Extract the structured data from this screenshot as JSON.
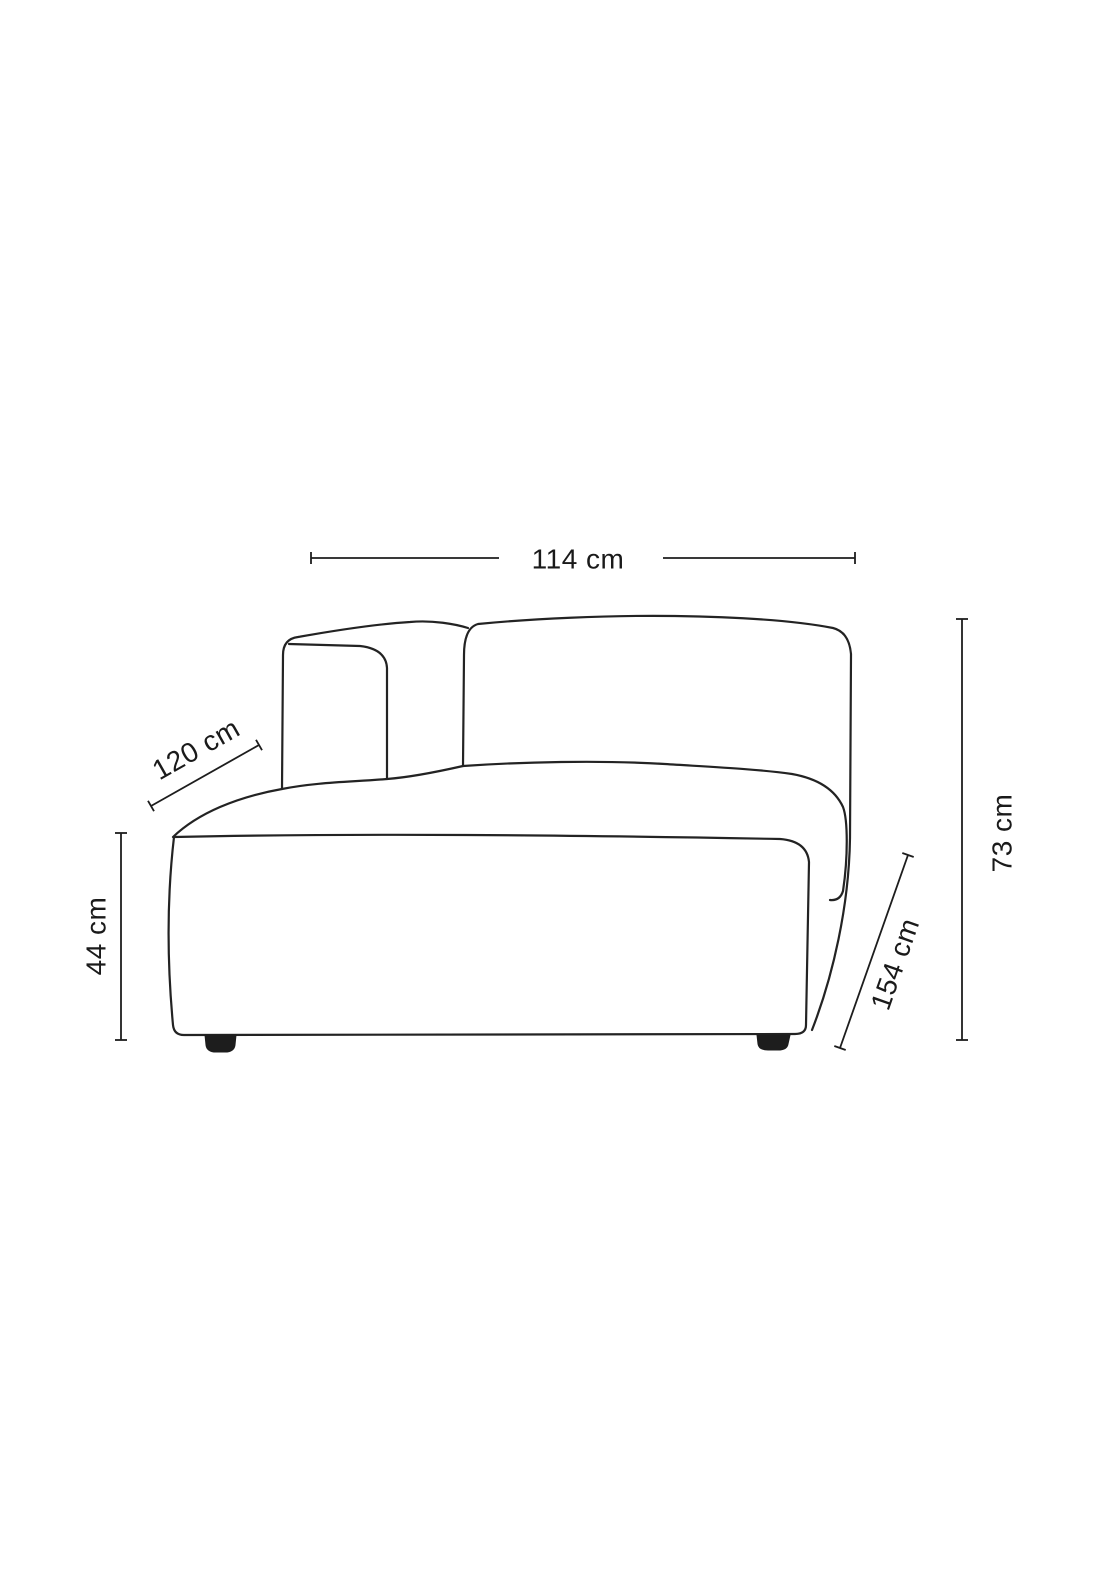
{
  "diagram": {
    "subject": "modular-sofa-chaise-outline",
    "background_color": "#ffffff",
    "line_color": "#232323",
    "feet_color": "#1d1d1d",
    "dimensions": {
      "width_top": {
        "label": "114 cm",
        "orientation": "horizontal"
      },
      "back_edge": {
        "label": "120 cm",
        "orientation": "diagonal"
      },
      "seat_height": {
        "label": "44 cm",
        "orientation": "vertical"
      },
      "total_height": {
        "label": "73 cm",
        "orientation": "vertical"
      },
      "depth": {
        "label": "154 cm",
        "orientation": "diagonal"
      }
    }
  }
}
